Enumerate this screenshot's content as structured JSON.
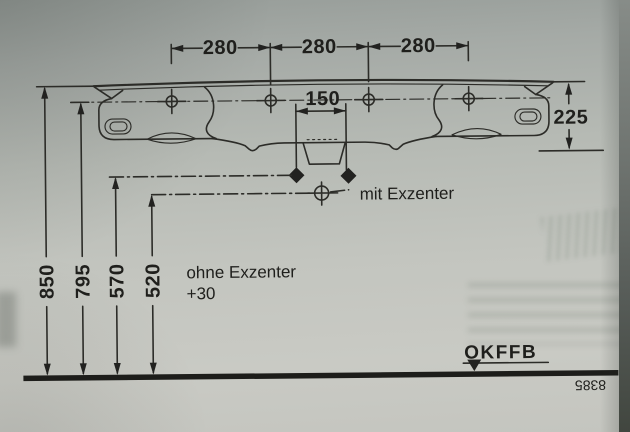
{
  "drawing": {
    "top_dims": [
      "280",
      "280",
      "280"
    ],
    "tap_spacing_dim": "150",
    "depth_dim": "225",
    "height_dims": [
      "850",
      "795",
      "570",
      "520"
    ],
    "with_eccentric_label": "mit Exzenter",
    "without_eccentric_label": "ohne Exzenter",
    "without_eccentric_offset": "+30",
    "floor_level_label": "OKFFB",
    "drawing_number": "8385"
  },
  "colors": {
    "ink": "#2c2c28",
    "floor_line": "#1d1d1a",
    "paper_top": "#969c98",
    "paper_bottom": "#c9cac4"
  }
}
